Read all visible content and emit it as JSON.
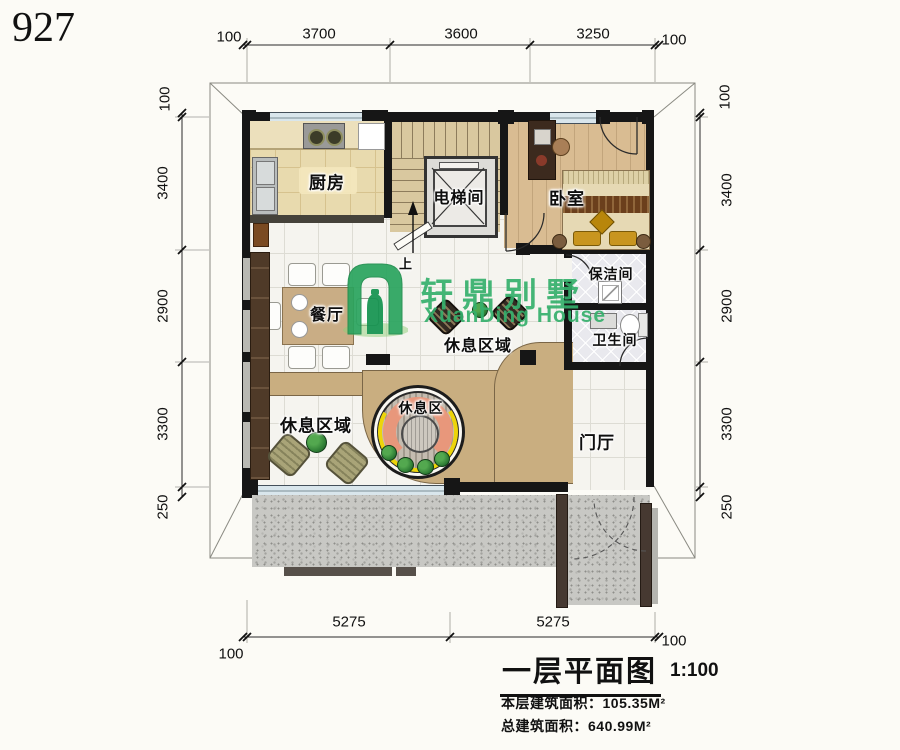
{
  "page": {
    "plan_number": "927"
  },
  "watermark": {
    "brand_cn": "轩鼎别墅",
    "brand_en": "XuanDing House",
    "color": "#35b06c"
  },
  "rooms": {
    "kitchen": "厨房",
    "elevator": "电梯间",
    "bedroom": "卧室",
    "dining": "餐厅",
    "rest_area_mid": "休息区域",
    "rest_area_left": "休息区域",
    "rest_circle": "休息区",
    "cleaning": "保洁间",
    "bathroom": "卫生间",
    "foyer": "门厅",
    "up": "上"
  },
  "dimensions": {
    "top": [
      "100",
      "3700",
      "3600",
      "3250",
      "100"
    ],
    "bottom": [
      "100",
      "5275",
      "5275",
      "100"
    ],
    "left": [
      "100",
      "3400",
      "2900",
      "3300",
      "250"
    ],
    "right": [
      "100",
      "3400",
      "2900",
      "3300",
      "250"
    ]
  },
  "title_block": {
    "title": "一层平面图",
    "scale": "1:100",
    "floor_area_label": "本层建筑面积：",
    "floor_area_value": "105.35M²",
    "total_area_label": "总建筑面积：",
    "total_area_value": "640.99M²"
  },
  "colors": {
    "wall": "#161616",
    "kitchen_floor": "#e8daae",
    "stair_floor": "#d9c89f",
    "bedroom_floor": "#d9bc92",
    "marble_floor": "#f5f4ef",
    "platform_tan": "#c9ae80",
    "patio_concrete": "#c8c8c4",
    "sofa_salmon": "#e8977b",
    "accent_yellow": "#edd50a",
    "plant_green": "#2c7a33",
    "window_blue": "#d9e6ec",
    "logo_green": "#35b06c"
  }
}
